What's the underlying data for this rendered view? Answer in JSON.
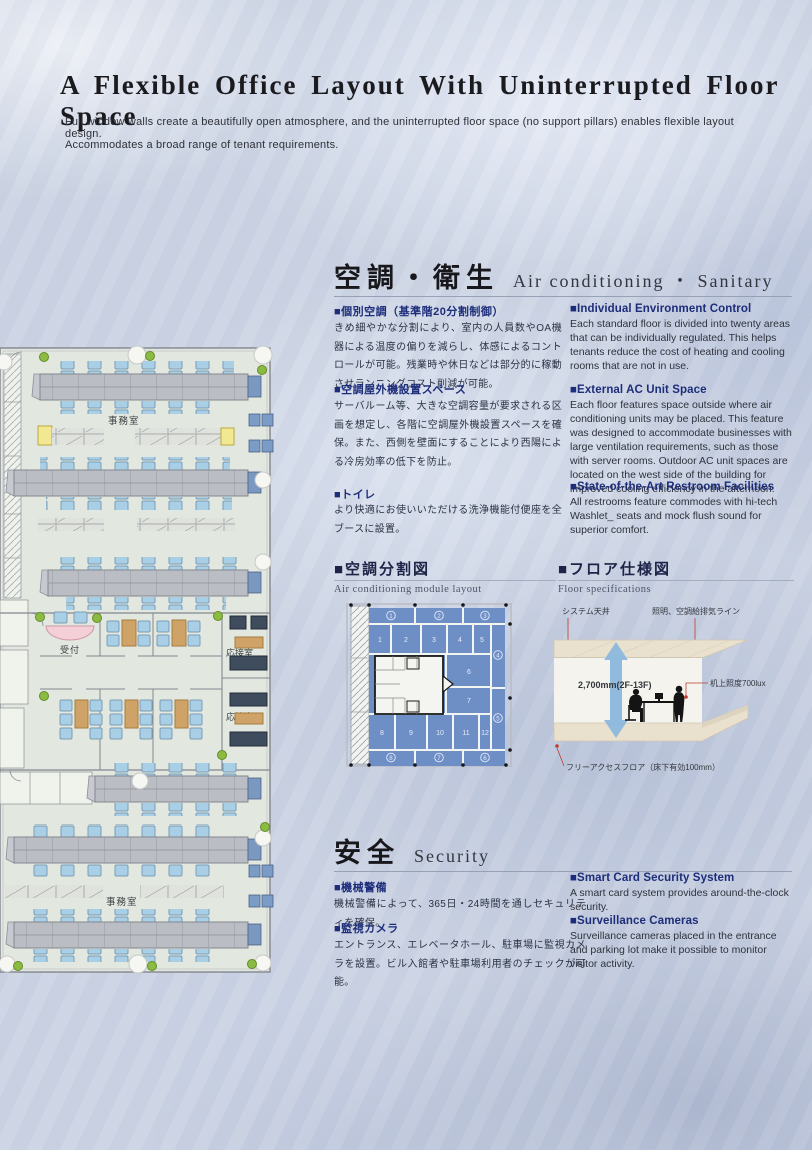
{
  "page": {
    "title": "A Flexible Office Layout With Uninterrupted Floor Space",
    "subtitle_line1": "Full window walls create a beautifully open atmosphere, and the uninterrupted floor space (no support pillars) enables flexible layout design.",
    "subtitle_line2": "Accommodates a broad range of tenant requirements."
  },
  "colors": {
    "heading_navy": "#1d2d7a",
    "zone_blue": "#6e8ec6",
    "chair_blue": "#a9cfe6",
    "desk_gray": "#babdc3",
    "table_tan": "#cfa368",
    "sofa_navy": "#3e4c5e",
    "reception_pink": "#f4cfd8",
    "leader_red": "#c03b30"
  },
  "aircon_section": {
    "title_jp": "空調・衛生",
    "title_en": "Air conditioning ・ Sanitary",
    "left": [
      {
        "heading": "■個別空調（基準階20分割制御）",
        "body": "きめ細やかな分割により、室内の人員数やOA機器による温度の偏りを減らし、体感によるコントロールが可能。残業時や休日などは部分的に稼動させランニングコスト削減が可能。"
      },
      {
        "heading": "■空調屋外機設置スペース",
        "body": "サーバルーム等、大きな空調容量が要求される区画を想定し、各階に空調屋外機設置スペースを確保。また、西側を壁面にすることにより西陽による冷房効率の低下を防止。"
      },
      {
        "heading": "■トイレ",
        "body": "より快適にお使いいただける洗浄機能付便座を全ブースに設置。"
      }
    ],
    "right": [
      {
        "heading": "■Individual Environment Control",
        "body": "Each standard floor is divided into twenty areas that can be individually regulated. This helps tenants reduce the cost of heating and cooling rooms that are not in use."
      },
      {
        "heading": "■External AC Unit Space",
        "body": "Each floor features space outside where air conditioning units may be placed. This feature was designed to accommodate businesses with large ventilation requirements, such as those with server rooms. Outdoor AC unit spaces are located on the west side of the building for improved cooling efficiency in the afternoon."
      },
      {
        "heading": "■State-of-the-Art Restroom Facilities",
        "body": "All restrooms feature commodes with hi-tech Washlet_ seats and mock flush sound for superior comfort."
      }
    ]
  },
  "module_layout": {
    "heading_jp": "■空調分割図",
    "heading_en": "Air conditioning module layout",
    "interior_zones": [
      "1",
      "2",
      "3",
      "4",
      "5",
      "6",
      "7",
      "8",
      "9",
      "10",
      "11",
      "12"
    ],
    "perimeter_zones": [
      "1",
      "2",
      "3",
      "4",
      "5",
      "6",
      "7",
      "8"
    ]
  },
  "floor_spec": {
    "heading_jp": "■フロア仕様図",
    "heading_en": "Floor specifications",
    "label_ceiling": "システム天井",
    "label_lighting": "照明、空調給排気ライン",
    "label_height": "2,700mm(2F-13F)",
    "label_lux": "机上照度700lux",
    "label_floor": "フリーアクセスフロア（床下有効100mm）"
  },
  "security_section": {
    "title_jp": "安全",
    "title_en": "Security",
    "left": [
      {
        "heading": "■機械警備",
        "body": "機械警備によって、365日・24時間を通しセキュリティを確保。"
      },
      {
        "heading": "■監視カメラ",
        "body": "エントランス、エレベータホール、駐車場に監視カメラを設置。ビル入館者や駐車場利用者のチェックが可能。"
      }
    ],
    "right": [
      {
        "heading": "■Smart Card Security System",
        "body": "A smart card system provides around-the-clock security."
      },
      {
        "heading": "■Surveillance Cameras",
        "body": "Surveillance cameras placed in the entrance and parking lot make it possible to monitor visitor activity."
      }
    ]
  },
  "floor_plan": {
    "labels": {
      "office_upper": "事務室",
      "reception": "受付",
      "meeting_1": "応接室",
      "meeting_2": "応接室",
      "office_lower": "事務室"
    }
  }
}
